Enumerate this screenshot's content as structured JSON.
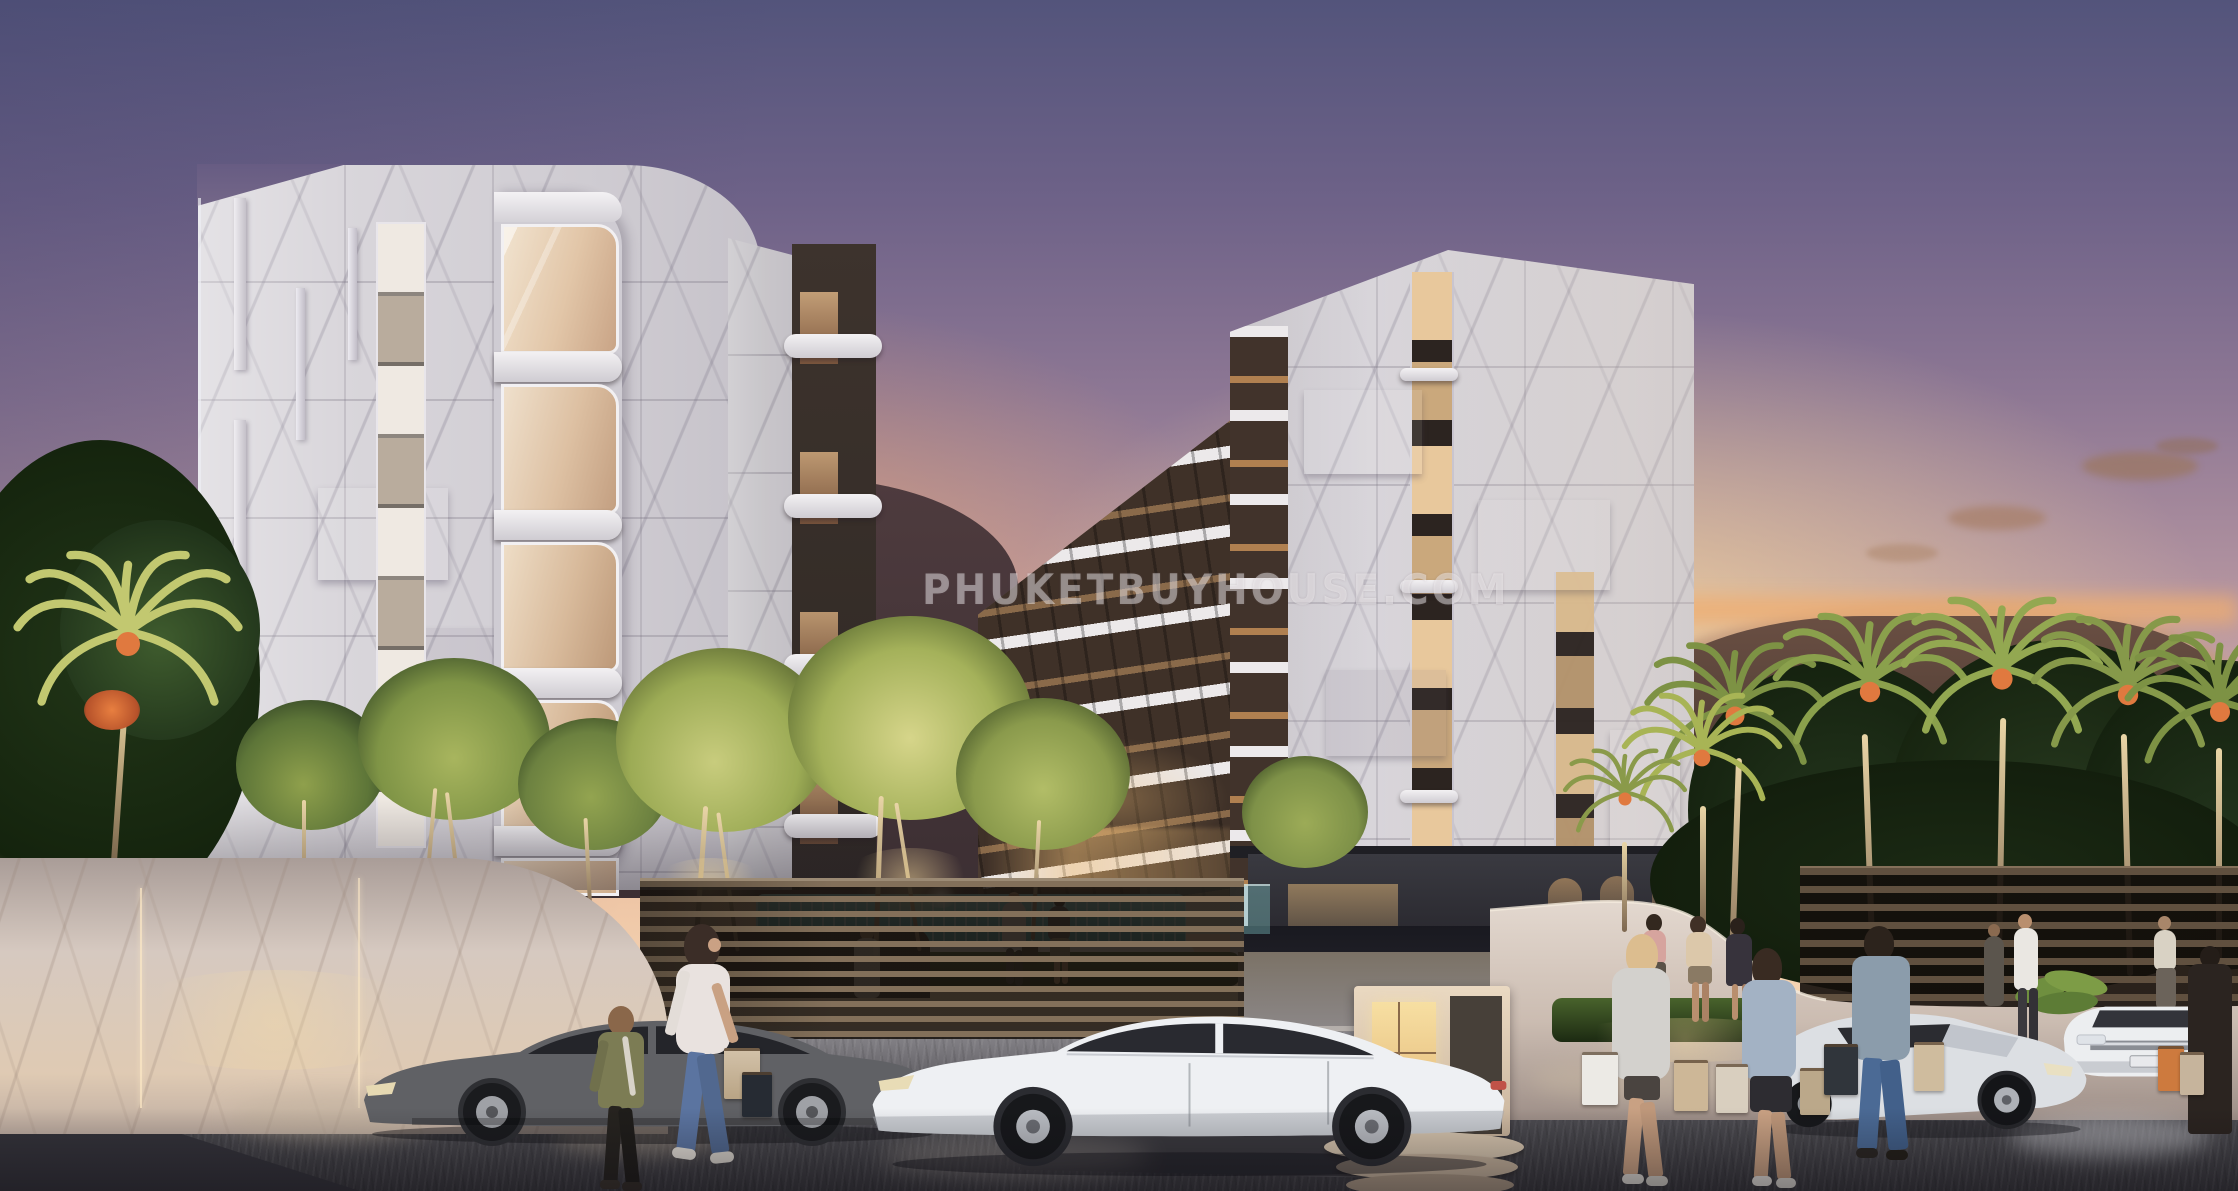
{
  "description": "Sunset architectural rendering of a modern marble condominium complex with illuminated courtyard trees, cascade pool, royal palm row, perimeter walls, four cars and pedestrians carrying shopping bags",
  "watermark": {
    "text": "PHUKETBUYHOUSE.COM",
    "color": "#ffffff",
    "opacity": 0.42
  },
  "palette": {
    "sky_top": "#54557c",
    "sky_mauve": "#9c869c",
    "sky_pink": "#d4aba6",
    "sky_peach": "#f3cfa4",
    "sky_glow": "#f9e4bd",
    "sunset_orange": "#ef9f62",
    "cloud": "#8f6f60",
    "marble_light": "#dcd9de",
    "marble_shadow": "#b7b2bc",
    "marble_vein": "#9d96a5",
    "window_bronze": "#3a2f29",
    "window_warm": "#e9cda2",
    "balcony_band_white": "#eceaec",
    "mountain_far": "#b58a75",
    "mountain_dark": "#4a3a3c",
    "palm_lit": "#aab054",
    "palm_dark": "#35502c",
    "flower_orange": "#e4733c",
    "tree_lit": "#b8c06d",
    "foliage_dark": "#1f2e1b",
    "wall_marble": "#d7cac1",
    "fence_slat": "#6f5c49",
    "street": "#47464b",
    "plaza": "#8b898f",
    "pool_teal": "#5fc3c4",
    "light_warm": "#f2d8a6",
    "car_white": "#edeff2",
    "car_gray": "#5d5e62",
    "car_silver": "#d9dce0"
  },
  "scene": {
    "buildings": [
      "left marble tower",
      "center low-rise wing",
      "right marble tower"
    ],
    "vehicles": [
      "gray sedan",
      "white luxury sedan",
      "silver hatchback",
      "white compact car"
    ],
    "environment": [
      "sunset sky",
      "mountain ridges",
      "royal palm row",
      "illuminated courtyard trees",
      "cascade fountain pool",
      "marble perimeter wall",
      "slatted fence",
      "guard booth"
    ],
    "people_count": 16
  }
}
